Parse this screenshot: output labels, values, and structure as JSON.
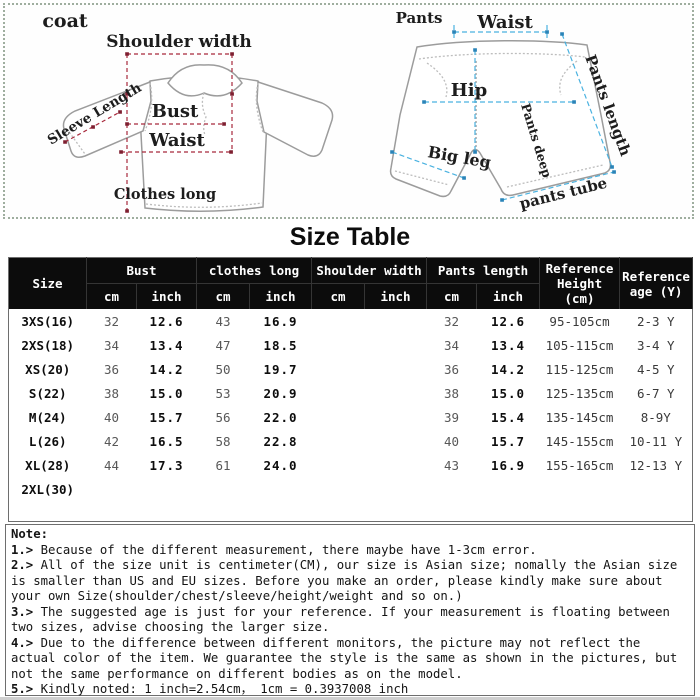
{
  "diagrams": {
    "coat": {
      "title": "coat",
      "measure_color": "#a8293c",
      "marker_color": "#7e1f30",
      "labels": {
        "shoulder_width": "Shoulder width",
        "sleeve_length": "Sleeve Length",
        "bust": "Bust",
        "waist": "Waist",
        "clothes_long": "Clothes long"
      }
    },
    "pants": {
      "title": "Pants",
      "measure_color": "#4ab2e0",
      "marker_color": "#2a84b8",
      "labels": {
        "waist": "Waist",
        "hip": "Hip",
        "big_leg": "Big leg",
        "pants_deep": "Pants deep",
        "pants_length": "Pants length",
        "pants_tube": "pants tube"
      }
    }
  },
  "size_table": {
    "title": "Size Table",
    "header": {
      "size_label": "Size",
      "groups": [
        {
          "label": "Bust"
        },
        {
          "label": "clothes long"
        },
        {
          "label": "Shoulder width"
        },
        {
          "label": "Pants length"
        }
      ],
      "unit_cm": "cm",
      "unit_inch": "inch",
      "reference_height_label": "Reference Height (cm)",
      "reference_age_label": "Reference age (Y)"
    },
    "rows": [
      {
        "size": "3XS(16)",
        "cells": [
          "32",
          "12.6",
          "43",
          "16.9",
          "",
          "",
          "32",
          "12.6",
          "95-105cm",
          "2-3 Y"
        ]
      },
      {
        "size": "2XS(18)",
        "cells": [
          "34",
          "13.4",
          "47",
          "18.5",
          "",
          "",
          "34",
          "13.4",
          "105-115cm",
          "3-4 Y"
        ]
      },
      {
        "size": "XS(20)",
        "cells": [
          "36",
          "14.2",
          "50",
          "19.7",
          "",
          "",
          "36",
          "14.2",
          "115-125cm",
          "4-5 Y"
        ]
      },
      {
        "size": "S(22)",
        "cells": [
          "38",
          "15.0",
          "53",
          "20.9",
          "",
          "",
          "38",
          "15.0",
          "125-135cm",
          "6-7 Y"
        ]
      },
      {
        "size": "M(24)",
        "cells": [
          "40",
          "15.7",
          "56",
          "22.0",
          "",
          "",
          "39",
          "15.4",
          "135-145cm",
          "8-9Y"
        ]
      },
      {
        "size": "L(26)",
        "cells": [
          "42",
          "16.5",
          "58",
          "22.8",
          "",
          "",
          "40",
          "15.7",
          "145-155cm",
          "10-11 Y"
        ]
      },
      {
        "size": "XL(28)",
        "cells": [
          "44",
          "17.3",
          "61",
          "24.0",
          "",
          "",
          "43",
          "16.9",
          "155-165cm",
          "12-13 Y"
        ]
      },
      {
        "size": "2XL(30)",
        "cells": [
          "",
          "",
          "",
          "",
          "",
          "",
          "",
          "",
          "",
          ""
        ]
      }
    ]
  },
  "notes": {
    "heading": "Note:",
    "items": [
      {
        "num": "1.>",
        "text": "Because of the different measurement, there maybe have 1-3cm error."
      },
      {
        "num": "2.>",
        "text": "All of the size unit is centimeter(CM), our size is Asian size; nomally the Asian size is smaller than US and EU sizes. Before you make an order, please kindly make sure about your own Size(shoulder/chest/sleeve/height/weight and so on.)"
      },
      {
        "num": "3.>",
        "text": "The suggested age is just for your reference. If your measurement is floating between two sizes, advise choosing the larger size."
      },
      {
        "num": "4.>",
        "text": "Due to the difference between different monitors, the picture may not reflect the actual color of the item. We guarantee the style is the same as shown in the pictures, but not the same performance on different bodies as on the model."
      },
      {
        "num": "5.>",
        "text": "Kindly noted: 1 inch=2.54cm， 1cm = 0.3937008 inch"
      }
    ]
  }
}
